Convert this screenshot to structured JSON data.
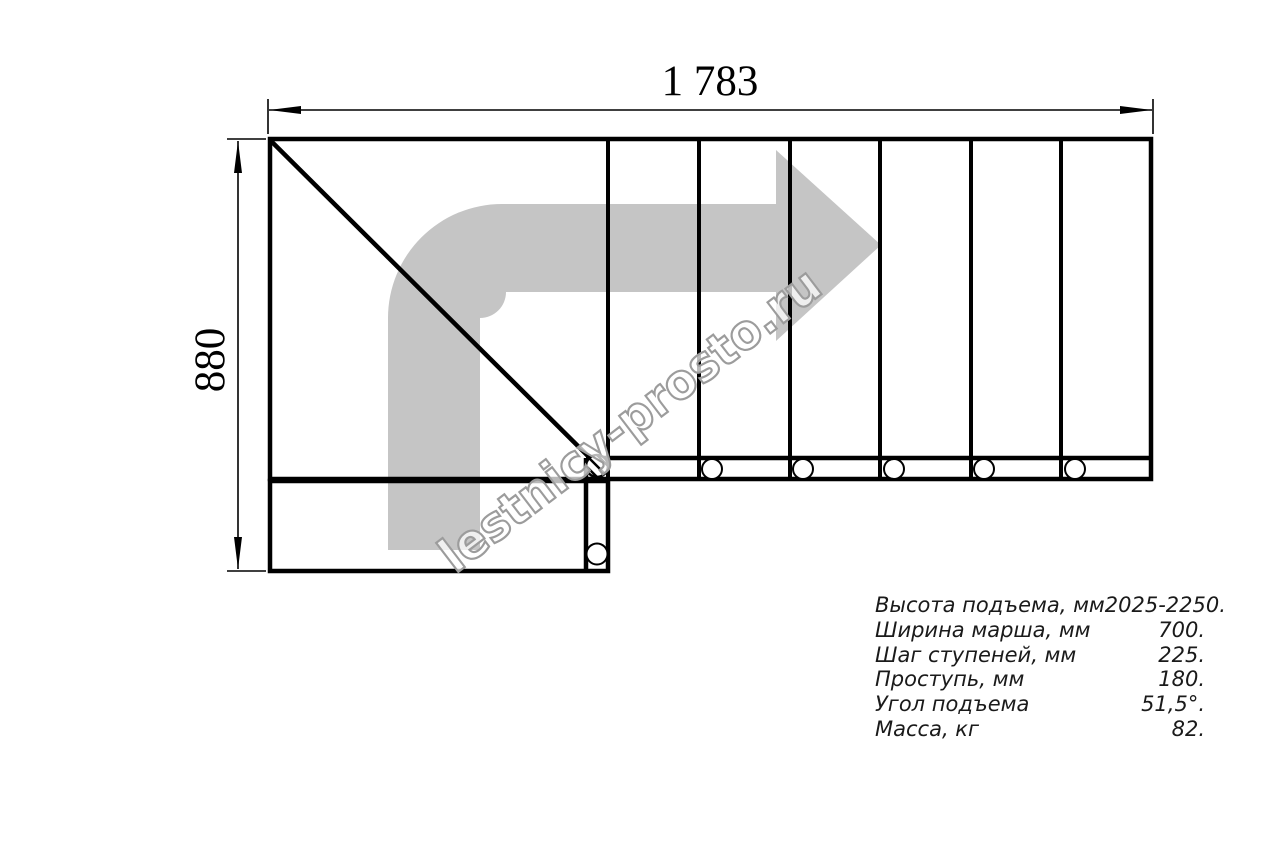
{
  "dimensions": {
    "width_label": "1 783",
    "height_label": "880"
  },
  "watermark": {
    "text": "lestnicy-prosto.ru"
  },
  "specs": {
    "rows": [
      {
        "label": "Высота подъема, мм",
        "value": "2025-2250."
      },
      {
        "label": "Ширина марша, мм",
        "value": "700."
      },
      {
        "label": "Шаг ступеней, мм",
        "value": "225."
      },
      {
        "label": "Проступь, мм",
        "value": "180."
      },
      {
        "label": "Угол подъема",
        "value": "51,5°."
      },
      {
        "label": "Масса, кг",
        "value": "82."
      }
    ]
  },
  "colors": {
    "line": "#000000",
    "arrow_fill": "#c5c5c5",
    "watermark_stroke": "#9c9c9c",
    "background": "#ffffff"
  }
}
